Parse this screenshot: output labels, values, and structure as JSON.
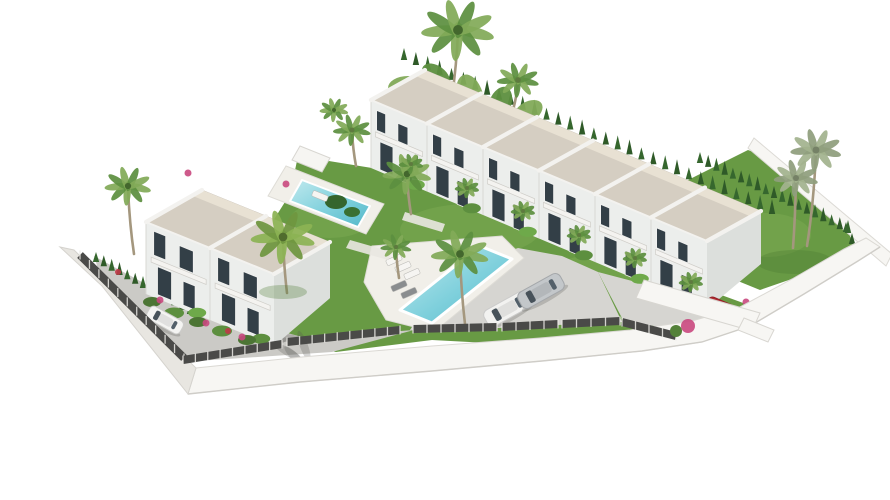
{
  "scene": {
    "type": "aerial 3D architectural rendering",
    "description": "Bird's-eye 3D render of a white Mediterranean townhouse development with landscaped gardens, two turquoise swimming pools, palm trees, a parking court with cars and a curved white perimeter wall, isolated on a white background",
    "background": "#ffffff"
  },
  "palette": {
    "roof": "#d5cec2",
    "ridge_white": "#f3f2ef",
    "facade": "#ecocec-fix",
    "facade_white": "#eceeec",
    "facade_shadow": "#dcdfdc",
    "window": "#333f47",
    "grass": "#689a44",
    "grass_light": "#7fae54",
    "grass_dark": "#4d7c33",
    "cypress": "#2f5a28",
    "palm_green": "#5d8f3f",
    "palm_light": "#82aa58",
    "palm_pale": "#a3b38e",
    "trunk": "#a4977e",
    "pool": "#7fd0dc",
    "pool_light": "#bfe9ee",
    "pool_deep": "#54b8c9",
    "deck": "#f1efe9",
    "paving": "#cbcac6",
    "paving_light": "#d6d5d1",
    "wall_white": "#f7f6f3",
    "wall_shade": "#e8e6e1",
    "fence": "#4a4a48",
    "flower_pink": "#c9487e",
    "flower_red": "#c03848"
  },
  "buildings": {
    "townhouse_row": {
      "label": "terraced townhouse row",
      "units": 6,
      "floors": 2
    },
    "duplex": {
      "label": "semi-detached duplex villa",
      "units": 2,
      "floors": 2
    }
  },
  "amenities": {
    "pools": [
      {
        "name": "communal-pool",
        "shape": "rectangular",
        "loungers": 5
      },
      {
        "name": "upper-garden-pool",
        "shape": "rectangular",
        "loungers": 1
      }
    ],
    "parking": {
      "name": "parking-court",
      "surface": "concrete",
      "cars": 2
    }
  },
  "vehicles": [
    {
      "name": "white-hatchback",
      "color": "#f4f4f2",
      "location": "left access road"
    },
    {
      "name": "white-sedan",
      "color": "#f2f2f0",
      "location": "parking court"
    },
    {
      "name": "silver-sedan",
      "color": "#c3c7ca",
      "location": "parking court"
    },
    {
      "name": "red-car",
      "color": "#b02830",
      "location": "entrance drive"
    }
  ],
  "vegetation": {
    "tall_palm_rear": "tall palm above the rear hedge",
    "roadside_palm": "slender fan palm beside the access road",
    "canary_palm": "dense round palm beside the duplex",
    "pool_palm": "weeping palm over the communal pool",
    "twin_palms_right": "two pale washingtonia palms on the right lawn",
    "hedges": "clipped cypress hedges along rear, left and right boundaries",
    "flower_colors": [
      "#c9487e",
      "#c03848"
    ]
  },
  "site": {
    "perimeter": "curved white retaining wall with dark mesh fence",
    "ground": "lawns, white sun decks and grey concrete drives"
  }
}
